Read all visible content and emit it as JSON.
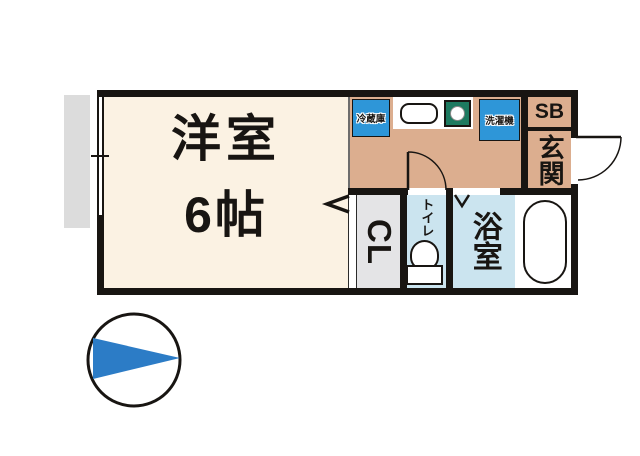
{
  "floorplan": {
    "rooms": {
      "living": {
        "name": "洋室",
        "size": "6帖"
      },
      "entrance": {
        "label": "玄関"
      },
      "shoe_box": {
        "label": "SB"
      },
      "closet": {
        "label": "CL"
      },
      "toilet": {
        "label": "トイレ"
      },
      "bathroom": {
        "label": "浴室"
      }
    },
    "appliances": {
      "refrigerator": {
        "label": "冷蔵庫"
      },
      "washing_machine": {
        "label": "洗濯機"
      }
    }
  },
  "colors": {
    "wall": "#181512",
    "living": "#FBF2E3",
    "kitchen": "#DCAE8F",
    "wet_room": "#CBE4EF",
    "closet": "#E4E4E6",
    "appliance": "#2E96D8",
    "stove": "#1D7A60",
    "balcony": "#DCDCDC",
    "compass": "#2C7CC6"
  }
}
